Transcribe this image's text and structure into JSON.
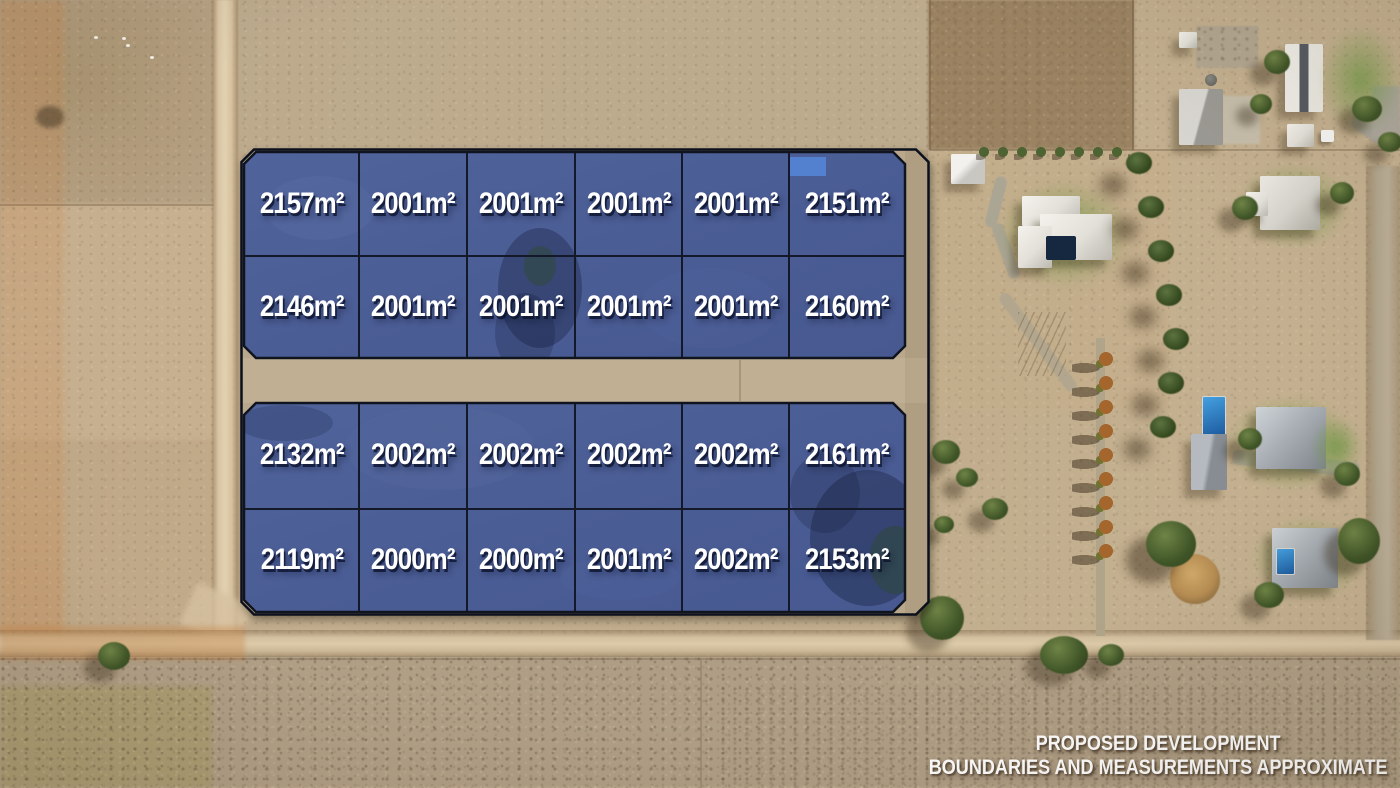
{
  "development": {
    "top_block": {
      "rows": [
        [
          "2157m²",
          "2001m²",
          "2001m²",
          "2001m²",
          "2001m²",
          "2151m²"
        ],
        [
          "2146m²",
          "2001m²",
          "2001m²",
          "2001m²",
          "2001m²",
          "2160m²"
        ]
      ]
    },
    "bottom_block": {
      "rows": [
        [
          "2132m²",
          "2002m²",
          "2002m²",
          "2002m²",
          "2002m²",
          "2161m²"
        ],
        [
          "2119m²",
          "2000m²",
          "2000m²",
          "2001m²",
          "2002m²",
          "2153m²"
        ]
      ]
    }
  },
  "overlay_text": {
    "line1": "PROPOSED DEVELOPMENT",
    "line2": "BOUNDARIES AND MEASUREMENTS APPROXIMATE"
  },
  "colors": {
    "lot_fill": "#4d5f98",
    "lot_border": "#12182a",
    "label_text": "#ffffff",
    "ground_tan": "#c3ae8e",
    "road_tan": "#d3c09f"
  }
}
